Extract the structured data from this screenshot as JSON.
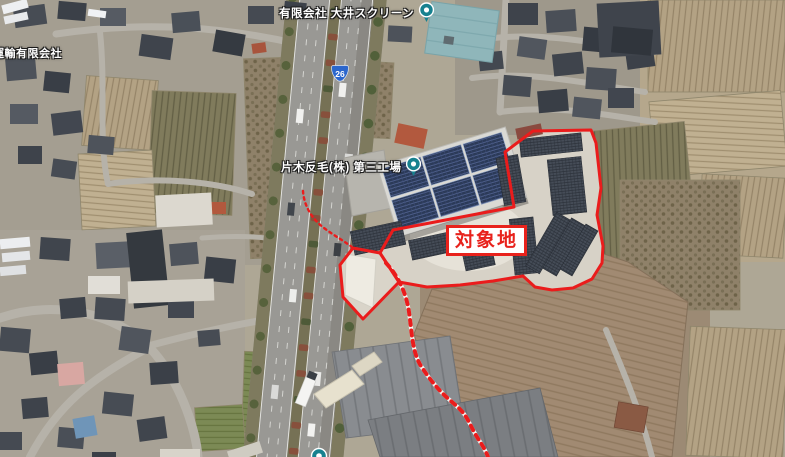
{
  "map_view": {
    "place_labels": [
      {
        "name": "有限会社 大井スクリーン"
      },
      {
        "name": "片木反毛(株) 第三工場"
      },
      {
        "name": "運輸有限会社"
      }
    ],
    "annotation": {
      "target_site_label": "対象地"
    },
    "route_shield": {
      "number": "26"
    },
    "colors": {
      "boundary_red": "#ea1c1c",
      "annotation_red": "#e8221c",
      "pin_teal": "#17818f",
      "route_shield_blue": "#2b66cc"
    }
  }
}
